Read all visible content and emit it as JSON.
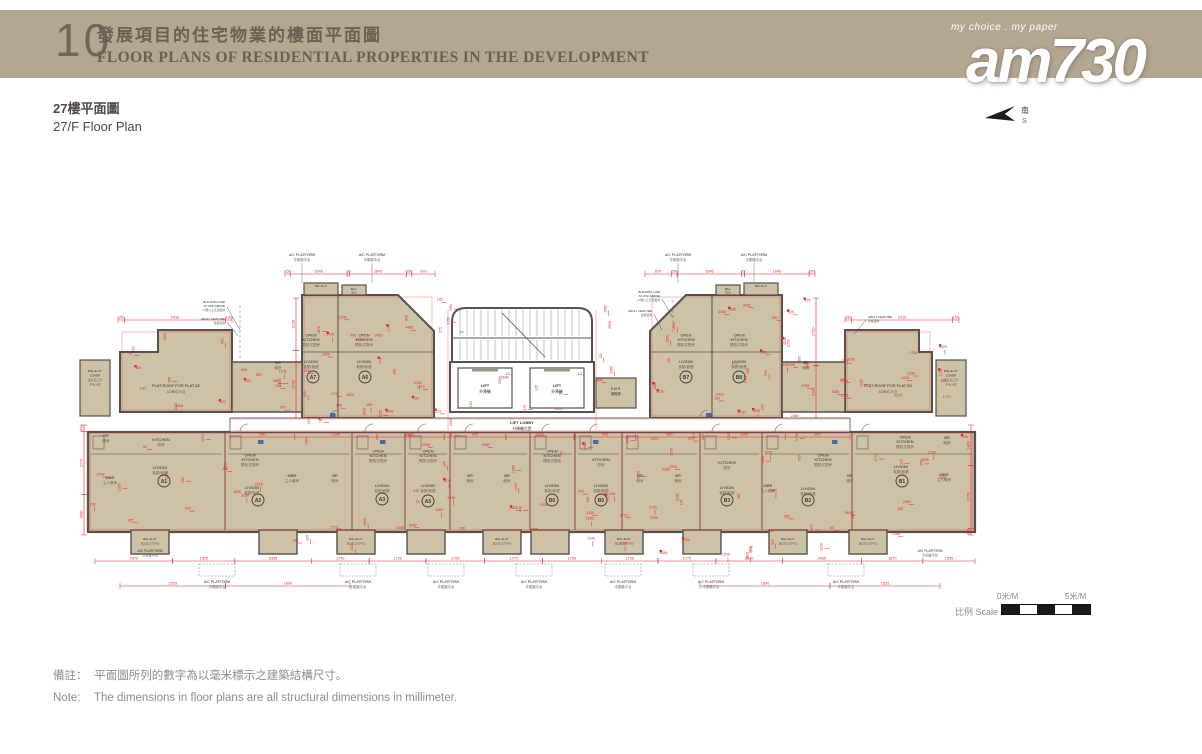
{
  "header": {
    "section_no": "10",
    "title_zh": "發展項目的住宅物業的樓面平面圖",
    "title_en": "FLOOR PLANS OF RESIDENTIAL PROPERTIES IN THE DEVELOPMENT",
    "band_color": "#b3a791",
    "text_color": "#6b6153"
  },
  "logo": {
    "tagline": "my choice . my paper",
    "name": "am730"
  },
  "compass": {
    "south_zh": "南",
    "south_en": "S"
  },
  "subtitle": {
    "zh": "27樓平面圖",
    "en": "27/F Floor Plan"
  },
  "scale_bar": {
    "label": "比例 Scale :",
    "start": "0米/M",
    "end": "5米/M"
  },
  "notes": {
    "zh_label": "備註：",
    "zh_text": "平面圖所列的數字為以毫米標示之建築結構尺寸。",
    "en_label": "Note:",
    "en_text": "The dimensions in floor plans are all structural dimensions in millimeter."
  },
  "plan": {
    "colors": {
      "room": "#cdc1a6",
      "wall": "#55514b",
      "dim": "#e8232b",
      "blue": "#3f5fae",
      "label": "#2f2d2a",
      "sub": "#6a675f"
    },
    "labels": {
      "lift": "LIFT",
      "lift_zh": "升降機",
      "lift_lobby": "LIFT LOBBY",
      "lift_lobby_zh": "升降機大堂",
      "l1": "L1",
      "l2": "L2",
      "emr": "E.M.R.",
      "emr_zh": "機電房",
      "up": "UP",
      "open_kitchen_1": "OPEN",
      "open_kitchen_2": "KITCHEN",
      "open_kitchen_zh": "開放式廚房",
      "kitchen": "KITCHEN",
      "kitchen_zh": "廚房",
      "livdin": "LIV/DIN",
      "livdin_zh": "客廳/飯廳",
      "mbr": "MBR",
      "mbr_zh": "主人睡房",
      "br": "BR",
      "br_zh": "睡房",
      "bal": "BAL.",
      "bal_zh": "露台",
      "balup": "BAL.&U.P.",
      "balup_zh": "露台及工作平台",
      "balup_cover_1": "BAL.&U.P.",
      "balup_cover_2": "COVER",
      "balup_cover_zh1": "露台及工作",
      "balup_cover_zh2": "平台上蓋",
      "ac": "A/C PLATFORM",
      "ac_zh": "冷氣機平台",
      "flat_roof_a2": "FLAT ROOF FOR FLAT A2",
      "flat_roof_a2_zh": "A2單位平台",
      "flat_roof_b2": "FLAT ROOF FOR FLAT B2",
      "flat_roof_b2_zh": "B2單位平台",
      "building_line_1": "BUILDING LINE",
      "building_line_2": "AT 27/F ABOVE",
      "building_line_zh": "27樓以上之建築線",
      "arch_feature": "ARCH. FEATURE",
      "arch_feature_zh": "建築裝飾"
    },
    "units_top": [
      "A7",
      "A6",
      "B7",
      "B8"
    ],
    "units_bottom": [
      "A1",
      "A2",
      "A3",
      "A5",
      "B6",
      "B5",
      "B3",
      "B2",
      "B1"
    ],
    "dim_rows_values": [
      [
        150,
        1645,
        75,
        1645,
        150,
        670
      ],
      [
        670,
        150,
        1645,
        75,
        1645,
        150
      ],
      [
        150,
        2410,
        150
      ],
      [
        150,
        2410,
        150
      ],
      [
        2370,
        1905,
        2335,
        1770,
        1735,
        1795,
        1770,
        1795,
        1735,
        1770,
        2030,
        2425,
        1870,
        1595
      ],
      [
        950,
        1205,
        985,
        905,
        1000,
        905,
        985,
        1205,
        950
      ],
      [
        300,
        2770,
        1800
      ],
      [
        1800,
        2770,
        300
      ],
      [
        2100,
        2700
      ],
      [
        2700,
        2100
      ],
      [
        1525,
        1800
      ],
      [
        1800,
        1525
      ]
    ],
    "dimensions_pool": [
      2410,
      150,
      75,
      1645,
      670,
      800,
      130,
      1205,
      985,
      905,
      200,
      1000,
      950,
      2335,
      1770,
      1735,
      1795,
      2030,
      2425,
      1905,
      2370,
      1525,
      1800,
      1595,
      1870,
      4485,
      1305,
      2230,
      2700,
      2100,
      2180,
      3180,
      300,
      2770,
      100,
      430,
      325,
      250,
      50,
      1605,
      940,
      1035,
      1930,
      2150,
      375,
      225,
      2360,
      1680,
      125,
      2050
    ]
  }
}
